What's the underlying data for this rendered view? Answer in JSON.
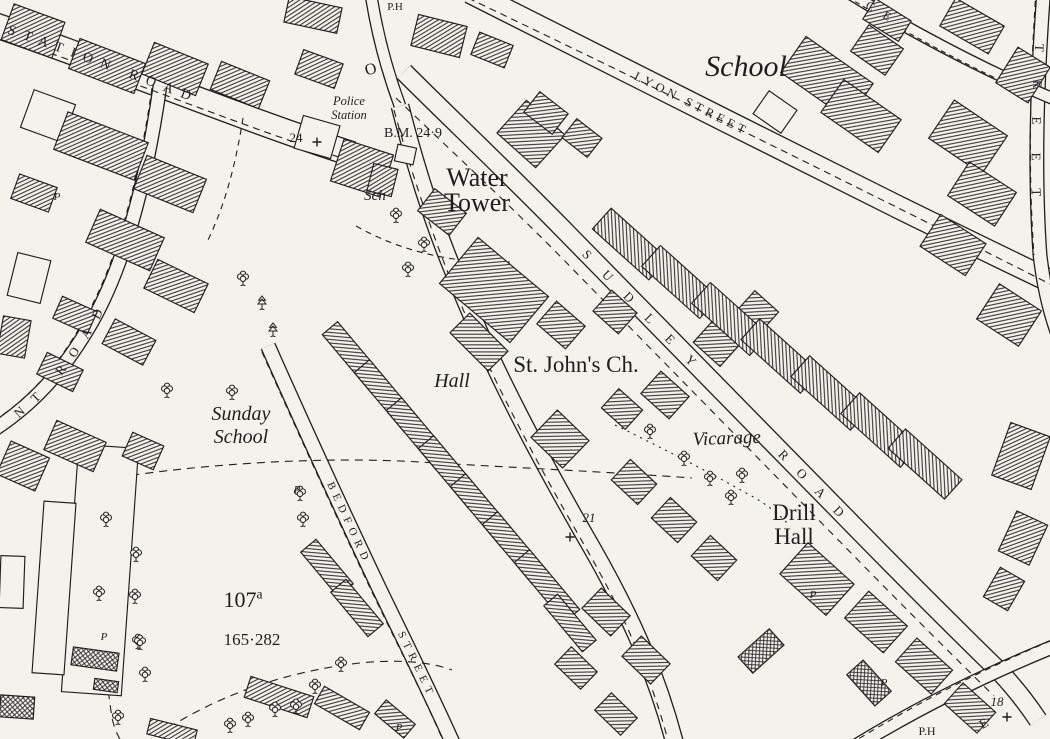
{
  "map": {
    "colors": {
      "paper": "#f4f2ec",
      "ink": "#1e1e1e"
    },
    "roads": [
      {
        "id": "station-road",
        "d": "M -20,20 C 100,60 240,118 352,154",
        "w": 26
      },
      {
        "id": "top-stub",
        "d": "M 370,-12 C 376,30 386,68 400,106",
        "w": 13
      },
      {
        "id": "main-road",
        "d": "M 400,106 C 415,165 432,220 455,275 C 492,368 540,458 592,548 C 632,618 658,678 676,748",
        "w": 19
      },
      {
        "id": "sudley-road",
        "d": "M 404,72 C 450,118 500,165 560,226 C 660,328 760,430 860,532 C 905,578 955,628 1000,672 C 1015,688 1028,705 1038,720",
        "w": 20
      },
      {
        "id": "lyon-street",
        "d": "M 470,-8 C 600,58 760,138 900,208 C 955,235 1010,262 1065,288",
        "w": 24
      },
      {
        "id": "bedford-street",
        "d": "M 268,346 C 300,418 340,506 378,586 C 405,642 432,696 455,748",
        "w": 16
      },
      {
        "id": "right-street",
        "d": "M 1044,-12 C 1037,80 1034,170 1040,255 C 1044,290 1052,322 1064,350",
        "w": 15
      },
      {
        "id": "topright-street",
        "d": "M 838,-14 C 888,18 950,52 1010,80 C 1028,88 1046,96 1066,104",
        "w": 13
      },
      {
        "id": "bottomright-road",
        "d": "M 846,752 C 910,712 980,676 1065,642",
        "w": 15
      },
      {
        "id": "nt-road",
        "d": "M 160,86 C 148,170 128,258 92,322 C 62,374 30,408 -16,436",
        "w": 15
      }
    ],
    "text_paths": [
      {
        "id": "nt-text",
        "d": "M -16,436 C 30,408 62,374 92,322 C 128,258 148,170 160,86"
      }
    ],
    "street_labels": [
      {
        "name": "station-road-name",
        "text": "STATION ROAD",
        "path": "rp-station-road",
        "offset": 30,
        "size": 14,
        "spacing": 8.5
      },
      {
        "name": "lyon-street-name",
        "text": "LYON STREET",
        "path": "rp-lyon-street",
        "offset": 185,
        "size": 12.5,
        "spacing": 4
      },
      {
        "name": "sudley-road-name-1",
        "text": "SUDLEY",
        "path": "rp-sudley-road",
        "offset": 255,
        "size": 13,
        "spacing": 21
      },
      {
        "name": "sudley-road-name-2",
        "text": "ROAD",
        "path": "rp-sudley-road",
        "offset": 535,
        "size": 13,
        "spacing": 17
      },
      {
        "name": "bedford-street-name-1",
        "text": "BEDFORD",
        "path": "rp-bedford-street",
        "offset": 150,
        "size": 11,
        "spacing": 5.5
      },
      {
        "name": "bedford-street-name-2",
        "text": "STREET",
        "path": "rp-bedford-street",
        "offset": 315,
        "size": 11,
        "spacing": 5.5
      },
      {
        "name": "nt-road-name",
        "text": "NT ROAD",
        "path": "nt-text",
        "offset": 38,
        "size": 13,
        "spacing": 13
      },
      {
        "name": "right-street-name",
        "text": "TREET",
        "path": "rp-right-street",
        "offset": 56,
        "size": 13,
        "spacing": 28
      },
      {
        "name": "topright-street-name",
        "text": "CE",
        "path": "rp-topright-street",
        "offset": 34,
        "size": 12,
        "spacing": 12
      }
    ],
    "labels": [
      {
        "name": "school-label",
        "lines": [
          "School"
        ],
        "x": 746,
        "y": 76,
        "size": 30,
        "italic": true
      },
      {
        "name": "water-tower-label",
        "lines": [
          "Water",
          "Tower"
        ],
        "x": 477,
        "y": 186,
        "size": 26,
        "lineh": 25
      },
      {
        "name": "st-johns-ch-label",
        "lines": [
          "St. John's Ch."
        ],
        "x": 576,
        "y": 372,
        "size": 23
      },
      {
        "name": "hall-label",
        "lines": [
          "Hall"
        ],
        "x": 452,
        "y": 387,
        "size": 20,
        "italic": true
      },
      {
        "name": "sunday-school-label",
        "lines": [
          "Sunday",
          "School"
        ],
        "x": 241,
        "y": 420,
        "size": 20,
        "lineh": 23,
        "italic": true
      },
      {
        "name": "vicarage-label",
        "lines": [
          "Vicarage"
        ],
        "x": 727,
        "y": 444,
        "size": 19,
        "italic": true,
        "rot": -2
      },
      {
        "name": "drill-hall-label",
        "lines": [
          "Drill",
          "Hall"
        ],
        "x": 794,
        "y": 520,
        "size": 23,
        "lineh": 24
      },
      {
        "name": "police-station-label",
        "lines": [
          "Police",
          "Station"
        ],
        "x": 349,
        "y": 105,
        "size": 12.5,
        "lineh": 14,
        "italic": true
      },
      {
        "name": "benchmark-label",
        "lines": [
          "B.M. 24·9"
        ],
        "x": 413,
        "y": 137,
        "size": 14
      },
      {
        "name": "sch-label",
        "lines": [
          "Sch"
        ],
        "x": 375,
        "y": 200,
        "size": 15,
        "italic": true
      },
      {
        "name": "parcel-number-label",
        "lines": [
          "107"
        ],
        "sup": "a",
        "x": 243,
        "y": 607,
        "size": 22
      },
      {
        "name": "parcel-area-label",
        "lines": [
          "165·282"
        ],
        "x": 252,
        "y": 645,
        "size": 17
      },
      {
        "name": "number-24",
        "lines": [
          "24"
        ],
        "x": 296,
        "y": 142,
        "size": 13
      },
      {
        "name": "number-21",
        "lines": [
          "21"
        ],
        "x": 589,
        "y": 522,
        "size": 13,
        "italic": true
      },
      {
        "name": "number-18",
        "lines": [
          "18"
        ],
        "x": 997,
        "y": 706,
        "size": 13,
        "italic": true
      },
      {
        "name": "ph-top-label",
        "lines": [
          "P.H"
        ],
        "x": 395,
        "y": 10,
        "size": 11
      },
      {
        "name": "ph-bottom-label",
        "lines": [
          "P.H"
        ],
        "x": 927,
        "y": 735,
        "size": 12
      },
      {
        "name": "letter-o-label",
        "lines": [
          "O"
        ],
        "x": 372,
        "y": 74,
        "size": 16,
        "rot": -15
      },
      {
        "name": "letter-e-label",
        "lines": [
          "E"
        ],
        "x": 986,
        "y": 727,
        "size": 13,
        "rot": -32
      }
    ],
    "p_markers": [
      [
        57,
        200
      ],
      [
        297,
        493
      ],
      [
        104,
        640
      ],
      [
        399,
        731
      ],
      [
        813,
        598
      ],
      [
        884,
        686
      ]
    ],
    "trees": [
      [
        243,
        277
      ],
      [
        167,
        389
      ],
      [
        232,
        391
      ],
      [
        300,
        492
      ],
      [
        303,
        518
      ],
      [
        106,
        518
      ],
      [
        99,
        592
      ],
      [
        136,
        553
      ],
      [
        135,
        595
      ],
      [
        138,
        640
      ],
      [
        145,
        673
      ],
      [
        140,
        641
      ],
      [
        341,
        663
      ],
      [
        315,
        685
      ],
      [
        296,
        705
      ],
      [
        275,
        708
      ],
      [
        248,
        718
      ],
      [
        230,
        724
      ],
      [
        118,
        716
      ],
      [
        396,
        214
      ],
      [
        424,
        243
      ],
      [
        408,
        268
      ],
      [
        650,
        430
      ],
      [
        684,
        457
      ],
      [
        710,
        477
      ],
      [
        731,
        496
      ],
      [
        742,
        474
      ]
    ],
    "conifers": [
      [
        262,
        302
      ],
      [
        273,
        329
      ]
    ],
    "crosses": [
      [
        317,
        142
      ],
      [
        570,
        537
      ],
      [
        1007,
        717
      ]
    ],
    "boundaries": [
      {
        "d": "M 90,482 C 190,464 320,456 420,462 C 520,468 610,472 692,478",
        "dash": "8 6"
      },
      {
        "d": "M 90,482 C 96,570 102,650 112,718 C 116,736 124,748 134,754",
        "dash": "8 6"
      },
      {
        "d": "M 134,752 C 200,700 280,672 360,663 C 400,659 430,662 452,670",
        "dash": "8 6"
      },
      {
        "d": "M 615,425 C 660,447 705,470 748,494 C 765,503 778,513 790,526",
        "dash": "2 5"
      },
      {
        "d": "M 243,118 C 236,162 226,204 206,244",
        "dash": "6 5"
      },
      {
        "d": "M 356,226 C 402,252 455,264 512,262",
        "dash": "6 5"
      },
      {
        "d": "M -18,30 C 100,68 240,126 348,160",
        "dash": "7 5"
      },
      {
        "d": "M 468,-2 C 610,66 780,148 1058,288",
        "dash": "7 5"
      },
      {
        "d": "M 394,110 C 410,168 428,222 450,278 C 487,370 534,458 586,548 C 626,618 652,678 670,748",
        "dash": "7 6"
      },
      {
        "d": "M 396,98 C 444,144 494,190 554,250 C 654,352 754,454 854,556 C 899,602 949,652 994,696",
        "dash": "7 6"
      },
      {
        "d": "M 262,352 C 294,424 334,512 372,592 C 399,648 426,700 448,752",
        "dash": "6 5"
      },
      {
        "d": "M 1036,-10 C 1030,80 1028,170 1034,255",
        "dash": "6 5"
      },
      {
        "d": "M 152,88 C 140,170 120,258 84,320 C 56,370 24,404 -20,430",
        "dash": "6 5"
      },
      {
        "d": "M 850,744 C 912,706 980,670 1062,636",
        "dash": "6 5"
      },
      {
        "d": "M 840,-8 C 890,24 952,58 1012,86",
        "dash": "5 4"
      }
    ],
    "buildings": [
      [
        286,
        2,
        54,
        26,
        12,
        0
      ],
      [
        414,
        20,
        50,
        32,
        14,
        0
      ],
      [
        474,
        38,
        36,
        24,
        22,
        0
      ],
      [
        146,
        52,
        58,
        34,
        22,
        0
      ],
      [
        214,
        70,
        52,
        30,
        22,
        0
      ],
      [
        6,
        12,
        54,
        38,
        20,
        0
      ],
      [
        72,
        50,
        70,
        32,
        21,
        0
      ],
      [
        26,
        96,
        44,
        40,
        20,
        1
      ],
      [
        58,
        126,
        86,
        40,
        21,
        0
      ],
      [
        138,
        166,
        64,
        36,
        22,
        0
      ],
      [
        14,
        180,
        40,
        26,
        20,
        0
      ],
      [
        90,
        222,
        70,
        36,
        24,
        0
      ],
      [
        148,
        270,
        56,
        32,
        26,
        0
      ],
      [
        56,
        303,
        38,
        24,
        24,
        0
      ],
      [
        106,
        328,
        46,
        28,
        28,
        0
      ],
      [
        12,
        256,
        34,
        44,
        14,
        1
      ],
      [
        0,
        318,
        28,
        38,
        10,
        0
      ],
      [
        40,
        360,
        40,
        24,
        26,
        0
      ],
      [
        298,
        120,
        38,
        34,
        16,
        1
      ],
      [
        336,
        146,
        52,
        44,
        18,
        0
      ],
      [
        396,
        146,
        19,
        17,
        12,
        1
      ],
      [
        298,
        56,
        42,
        26,
        20,
        0
      ],
      [
        370,
        166,
        25,
        28,
        14,
        0
      ],
      [
        422,
        198,
        40,
        28,
        38,
        0
      ],
      [
        505,
        112,
        52,
        44,
        42,
        0
      ],
      [
        448,
        260,
        92,
        60,
        40,
        0
      ],
      [
        542,
        310,
        38,
        30,
        41,
        0
      ],
      [
        598,
        298,
        34,
        28,
        42,
        0
      ],
      [
        538,
        420,
        44,
        38,
        44,
        0
      ],
      [
        606,
        396,
        32,
        26,
        42,
        0
      ],
      [
        646,
        380,
        38,
        30,
        42,
        0
      ],
      [
        698,
        330,
        36,
        28,
        42,
        0
      ],
      [
        742,
        298,
        32,
        26,
        42,
        0
      ],
      [
        616,
        206,
        28,
        76,
        -48,
        0
      ],
      [
        666,
        243,
        28,
        78,
        -48,
        0
      ],
      [
        716,
        280,
        28,
        78,
        -48,
        0
      ],
      [
        766,
        316,
        28,
        80,
        -48,
        0
      ],
      [
        816,
        353,
        28,
        80,
        -48,
        0
      ],
      [
        866,
        390,
        28,
        80,
        -48,
        0
      ],
      [
        912,
        426,
        26,
        76,
        -48,
        0
      ],
      [
        786,
        558,
        62,
        42,
        42,
        0
      ],
      [
        850,
        604,
        52,
        36,
        42,
        0
      ],
      [
        900,
        650,
        48,
        32,
        42,
        0
      ],
      [
        948,
        694,
        44,
        28,
        42,
        0
      ],
      [
        616,
        468,
        36,
        28,
        43,
        0
      ],
      [
        656,
        506,
        36,
        28,
        43,
        0
      ],
      [
        696,
        544,
        36,
        28,
        43,
        0
      ],
      [
        586,
        598,
        40,
        28,
        44,
        0
      ],
      [
        626,
        646,
        40,
        28,
        44,
        0
      ],
      [
        558,
        656,
        36,
        24,
        44,
        0
      ],
      [
        598,
        702,
        36,
        24,
        44,
        0
      ],
      [
        740,
        640,
        42,
        22,
        -42,
        2
      ],
      [
        858,
        662,
        22,
        42,
        -42,
        2
      ],
      [
        866,
        8,
        42,
        24,
        32,
        0
      ],
      [
        944,
        10,
        56,
        32,
        30,
        0
      ],
      [
        1004,
        54,
        38,
        42,
        32,
        0
      ],
      [
        936,
        114,
        64,
        46,
        34,
        0
      ],
      [
        954,
        174,
        56,
        40,
        33,
        0
      ],
      [
        926,
        226,
        54,
        38,
        33,
        0
      ],
      [
        984,
        294,
        50,
        42,
        33,
        0
      ],
      [
        1000,
        428,
        42,
        56,
        20,
        0
      ],
      [
        1006,
        516,
        34,
        44,
        25,
        0
      ],
      [
        990,
        572,
        28,
        34,
        30,
        0
      ],
      [
        786,
        56,
        82,
        44,
        35,
        0
      ],
      [
        826,
        96,
        70,
        40,
        35,
        0
      ],
      [
        856,
        34,
        42,
        32,
        35,
        0
      ],
      [
        758,
        98,
        34,
        28,
        35,
        1
      ],
      [
        528,
        100,
        36,
        26,
        38,
        0
      ],
      [
        566,
        126,
        32,
        24,
        38,
        0
      ],
      [
        452,
        328,
        54,
        28,
        45,
        0
      ],
      [
        316,
        348,
        78,
        20,
        50,
        0
      ],
      [
        348,
        386,
        78,
        20,
        50,
        0
      ],
      [
        380,
        424,
        78,
        20,
        50,
        0
      ],
      [
        412,
        462,
        78,
        20,
        50,
        0
      ],
      [
        444,
        500,
        78,
        20,
        50,
        0
      ],
      [
        476,
        538,
        78,
        20,
        50,
        0
      ],
      [
        508,
        576,
        78,
        20,
        50,
        0
      ],
      [
        540,
        614,
        60,
        18,
        50,
        0
      ],
      [
        298,
        558,
        58,
        20,
        50,
        0
      ],
      [
        328,
        598,
        58,
        20,
        50,
        0
      ],
      [
        246,
        686,
        66,
        22,
        18,
        0
      ],
      [
        316,
        698,
        52,
        20,
        30,
        0
      ],
      [
        376,
        710,
        38,
        18,
        40,
        0
      ],
      [
        148,
        724,
        48,
        16,
        14,
        0
      ],
      [
        70,
        446,
        60,
        248,
        4,
        1
      ],
      [
        38,
        502,
        32,
        172,
        4,
        1
      ],
      [
        48,
        430,
        54,
        32,
        24,
        0
      ],
      [
        2,
        448,
        42,
        36,
        24,
        0
      ],
      [
        126,
        438,
        34,
        26,
        24,
        0
      ],
      [
        72,
        650,
        46,
        18,
        8,
        2
      ],
      [
        94,
        680,
        24,
        11,
        8,
        2
      ],
      [
        0,
        556,
        24,
        52,
        2,
        1
      ],
      [
        0,
        696,
        34,
        22,
        4,
        2
      ]
    ]
  }
}
